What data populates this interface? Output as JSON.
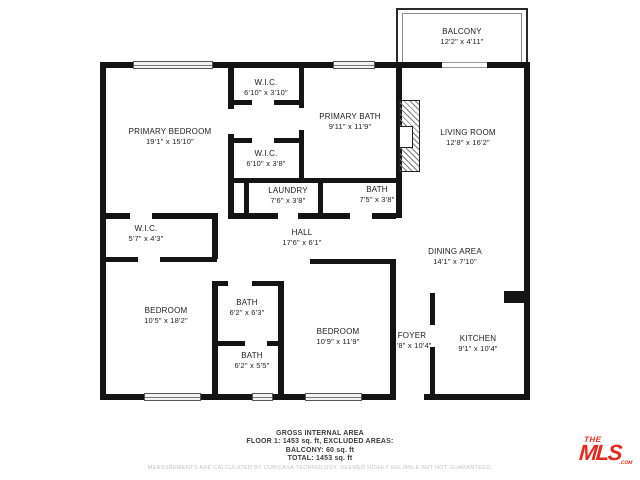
{
  "rooms": [
    {
      "name": "BALCONY",
      "dims": "12'2\" x 4'11\""
    },
    {
      "name": "W.I.C.",
      "dims": "6'10\" x 3'10\""
    },
    {
      "name": "PRIMARY BATH",
      "dims": "9'11\" x 11'9\""
    },
    {
      "name": "LIVING ROOM",
      "dims": "12'8\" x 16'2\""
    },
    {
      "name": "PRIMARY BEDROOM",
      "dims": "19'1\" x 15'10\""
    },
    {
      "name": "W.I.C.",
      "dims": "6'10\" x 3'8\""
    },
    {
      "name": "LAUNDRY",
      "dims": "7'6\" x 3'8\""
    },
    {
      "name": "BATH",
      "dims": "7'5\" x 3'8\""
    },
    {
      "name": "W.I.C.",
      "dims": "5'7\" x 4'3\""
    },
    {
      "name": "HALL",
      "dims": "17'6\" x 6'1\""
    },
    {
      "name": "DINING AREA",
      "dims": "14'1\" x 7'10\""
    },
    {
      "name": "BEDROOM",
      "dims": "10'5\" x 18'2\""
    },
    {
      "name": "BATH",
      "dims": "6'2\" x 6'3\""
    },
    {
      "name": "BEDROOM",
      "dims": "10'9\" x 11'9\""
    },
    {
      "name": "BATH",
      "dims": "6'2\" x 5'5\""
    },
    {
      "name": "FOYER",
      "dims": "4'8\" x 10'4\""
    },
    {
      "name": "KITCHEN",
      "dims": "9'1\" x 10'4\""
    }
  ],
  "footer": {
    "line1": "GROSS INTERNAL AREA",
    "line2": "FLOOR 1: 1453 sq. ft, EXCLUDED AREAS:",
    "line3": "BALCONY: 60 sq. ft",
    "line4": "TOTAL: 1453 sq. ft",
    "disclaimer": "MEASUREMENTS ARE CALCULATED BY CUBICASA TECHNOLOGY. DEEMED HIGHLY RELIABLE BUT NOT GUARANTEED."
  },
  "logo": {
    "the": "THE",
    "mls": "MLS",
    "com": ".COM"
  },
  "colors": {
    "wall": "#141414",
    "text": "#1c1c1c",
    "logo_red": "#e02b1e",
    "disclaimer": "#c3c3c3"
  }
}
